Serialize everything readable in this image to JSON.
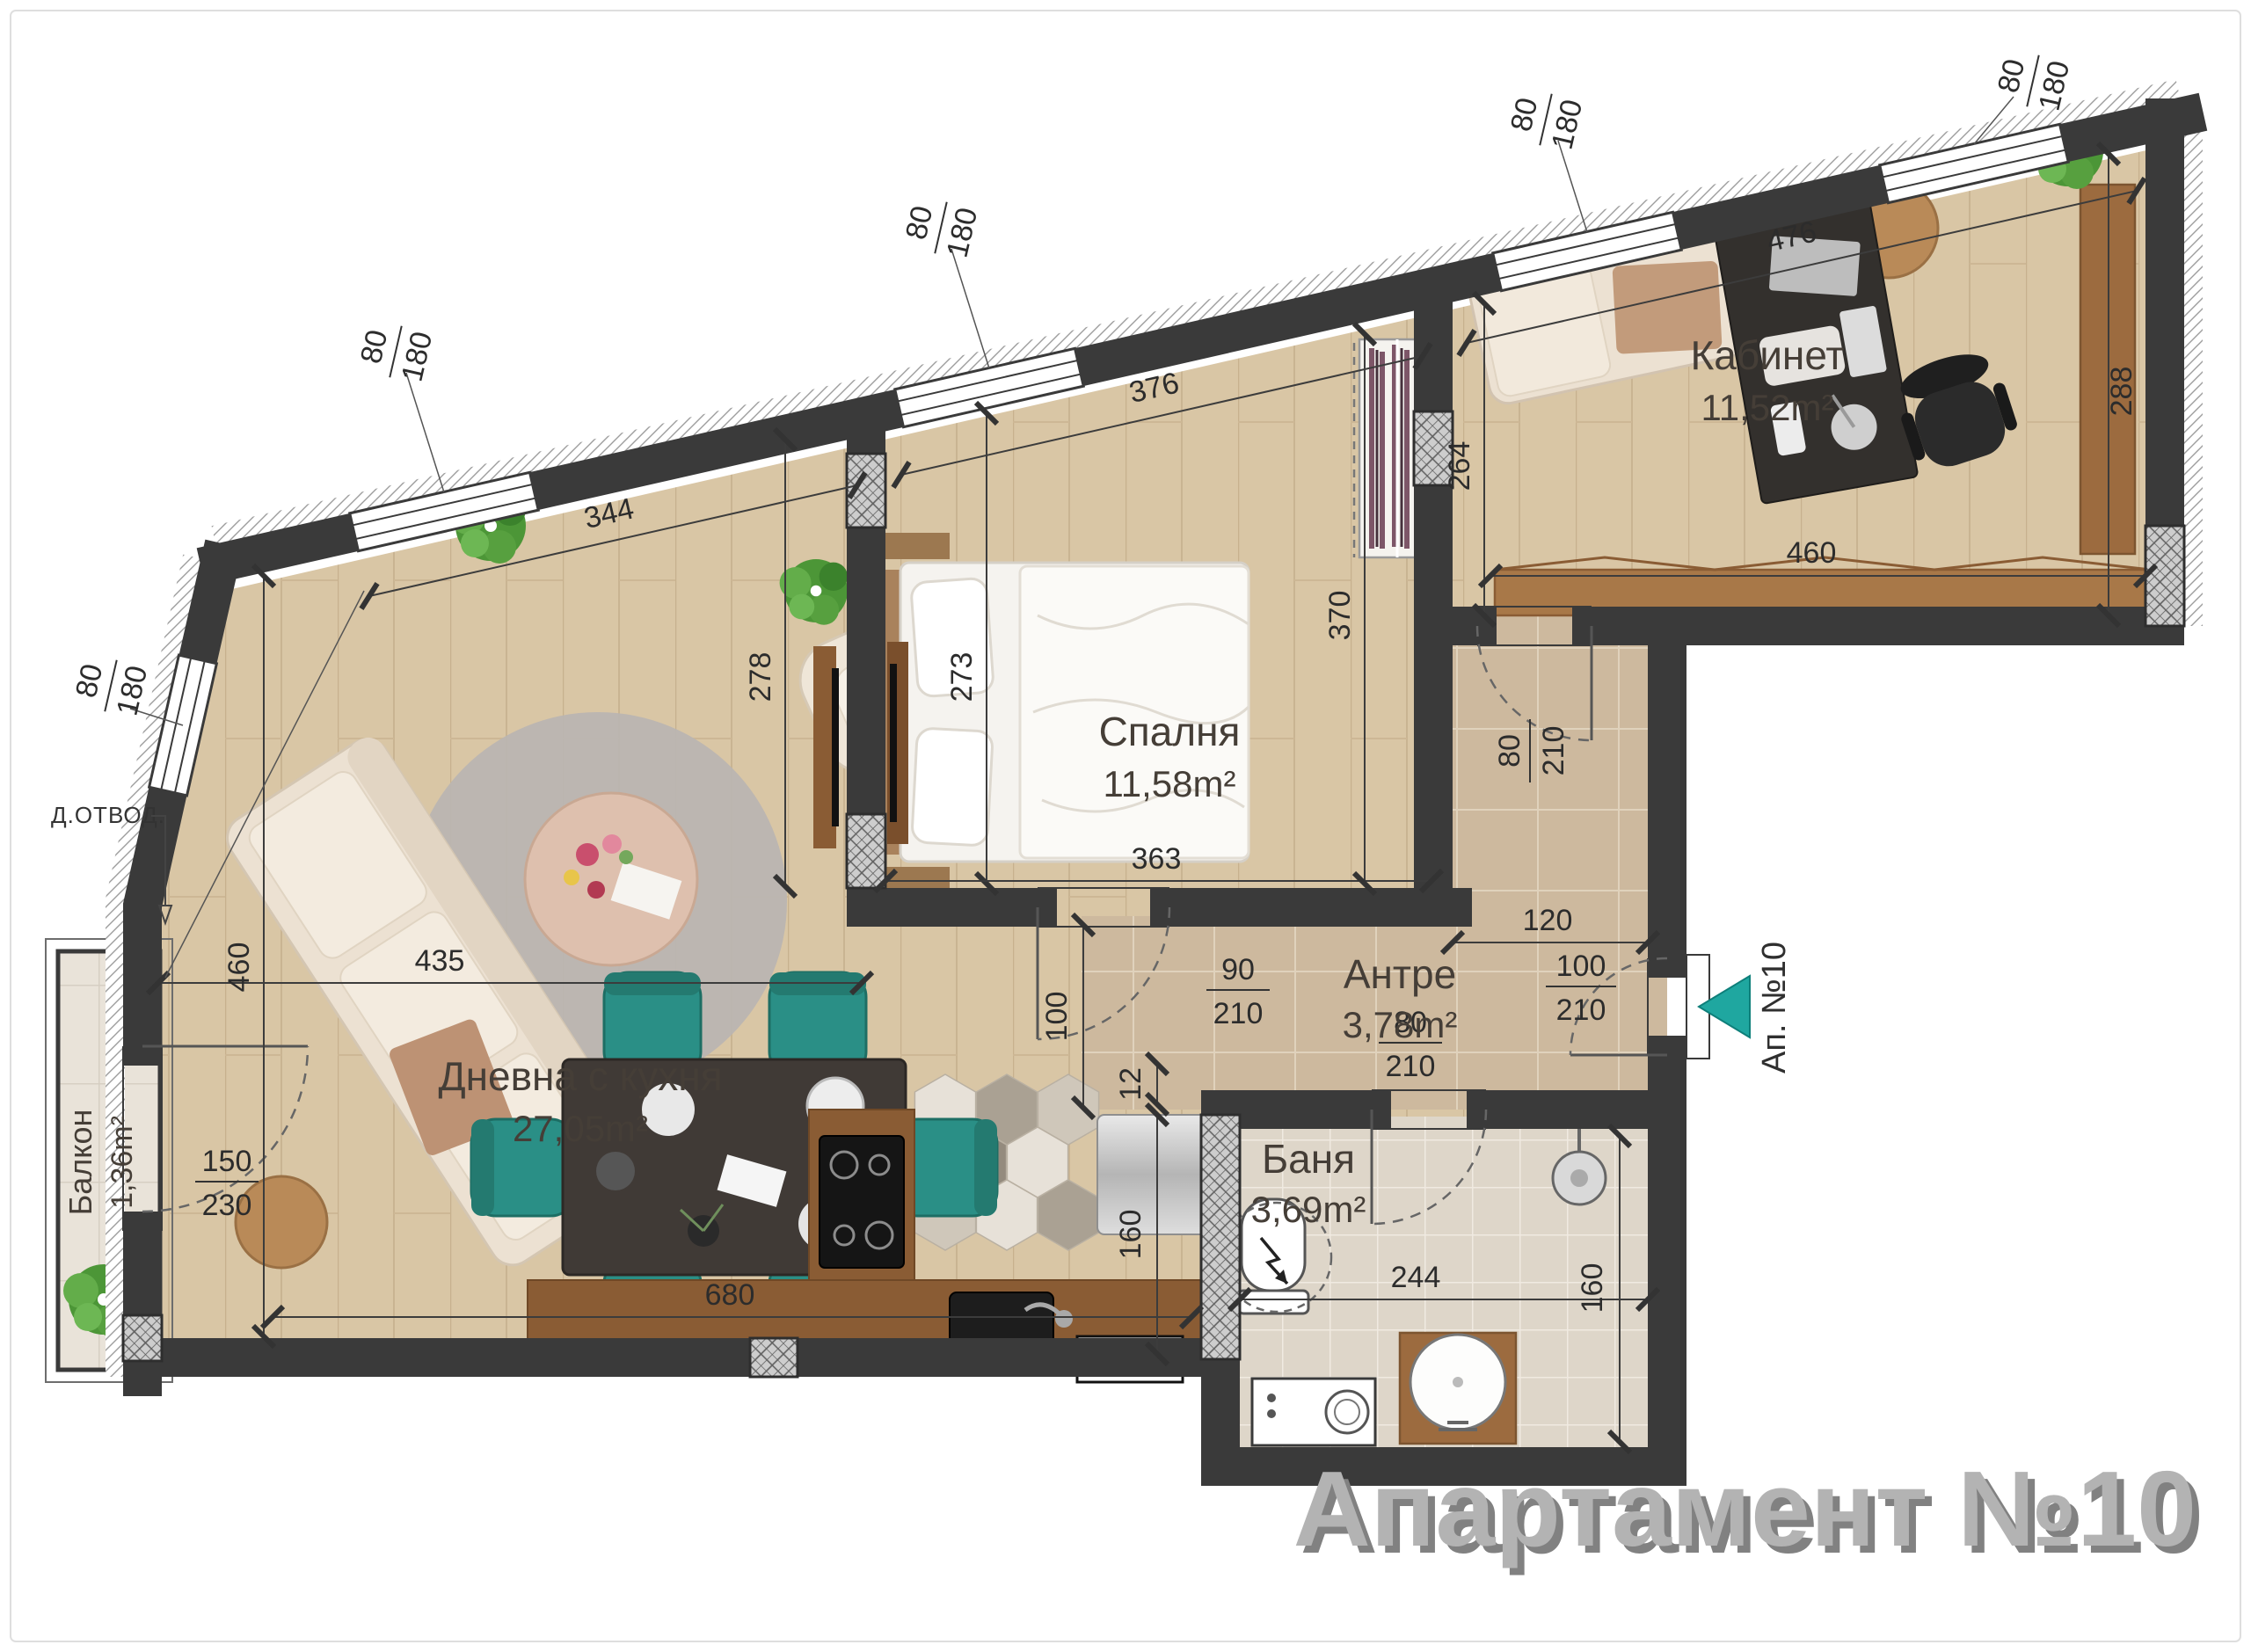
{
  "title": "Апартамент №10",
  "rooms": {
    "living": {
      "name": "Дневна с кухня",
      "area": "27,05m²"
    },
    "bedroom": {
      "name": "Спалня",
      "area": "11,58m²"
    },
    "office": {
      "name": "Кабинет",
      "area": "11,52m²"
    },
    "hall": {
      "name": "Антре",
      "area": "3,78m²"
    },
    "bath": {
      "name": "Баня",
      "area": "3,69m²"
    },
    "balcony": {
      "name": "Балкон",
      "area": "1,36m²"
    }
  },
  "labels": {
    "drain": "Д.ОТВОД.",
    "entrance": "Ап. №10"
  },
  "window_size": {
    "w": "80",
    "h": "180"
  },
  "doors": {
    "balcony": {
      "w": "150",
      "h": "230"
    },
    "bedroom": {
      "w": "90",
      "h": "210"
    },
    "office": {
      "w": "80",
      "h": "210"
    },
    "bath": {
      "w": "80",
      "h": "210"
    },
    "entrance": {
      "w": "100",
      "h": "210"
    }
  },
  "dims": {
    "living_top": "344",
    "living_diag": "435",
    "living_height": "460",
    "living_bottom": "680",
    "tv_wall": "278",
    "bedroom_top": "376",
    "bedroom_width": "363",
    "bedroom_depth": "273",
    "bedroom_right": "370",
    "office_diag": "476",
    "office_width": "460",
    "office_left": "264",
    "office_right": "288",
    "hall_width": "120",
    "hall_opening": "100",
    "kitchen_depth": "160",
    "kitchen_gap": "12",
    "bath_width": "244",
    "bath_depth": "160"
  },
  "colors": {
    "wall": "#3a3a3a",
    "accent_teal": "#1fa7a0",
    "chair_teal": "#2a8f86",
    "wood_floor": "#d9c6a5",
    "title_gray": "#b3b3b3"
  }
}
